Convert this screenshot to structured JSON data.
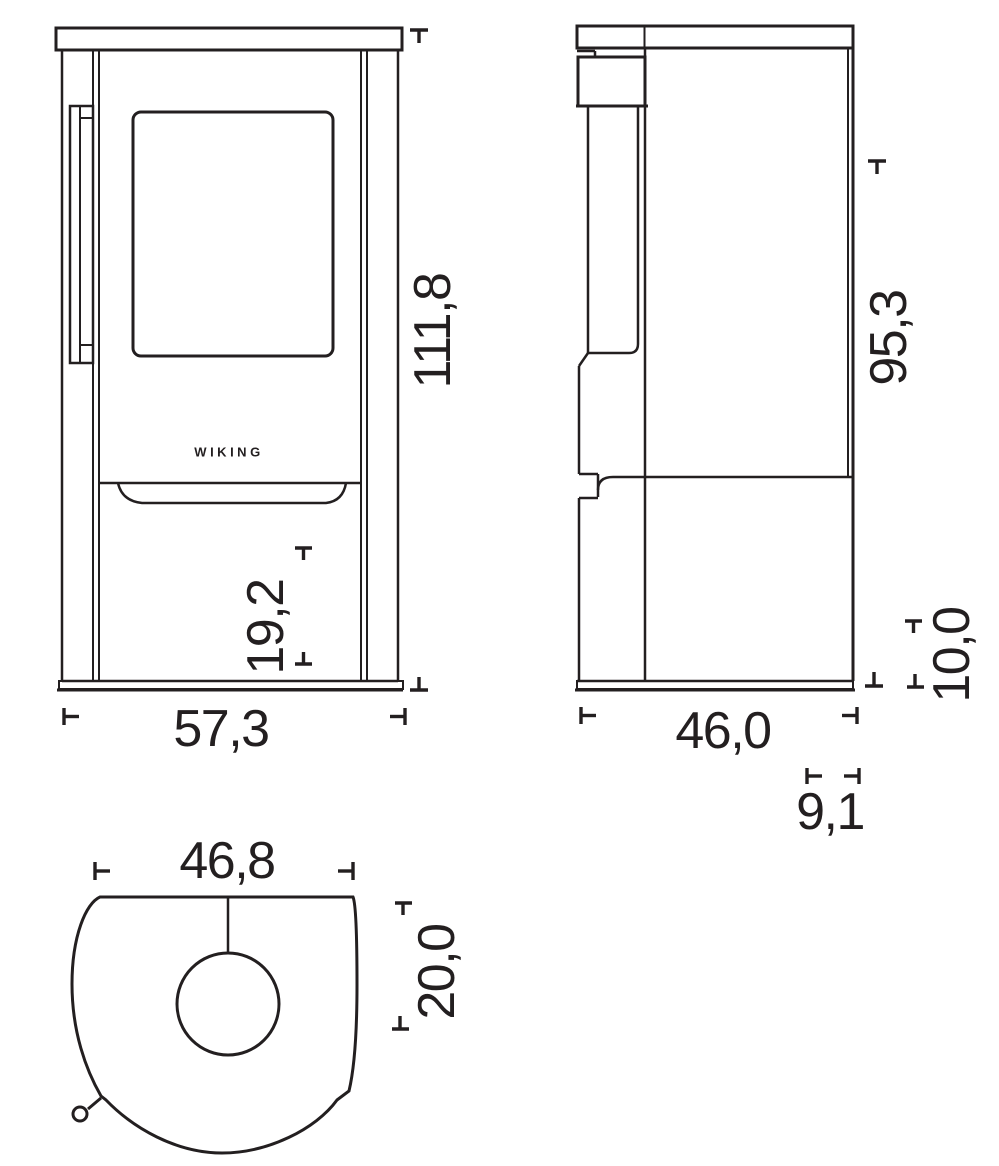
{
  "drawing": {
    "background": "#ffffff",
    "line_color": "#231f20",
    "brand": "WIKING",
    "front_view": {
      "height_cm": "111,8",
      "lower_section_cm": "19,2",
      "width_cm": "57,3"
    },
    "side_view": {
      "body_height_cm": "95,3",
      "plinth_height_cm": "10,0",
      "depth_cm": "46,0",
      "flue_offset_cm": "9,1"
    },
    "top_view": {
      "width_cm": "46,8",
      "flue_center_cm": "20,0"
    }
  }
}
